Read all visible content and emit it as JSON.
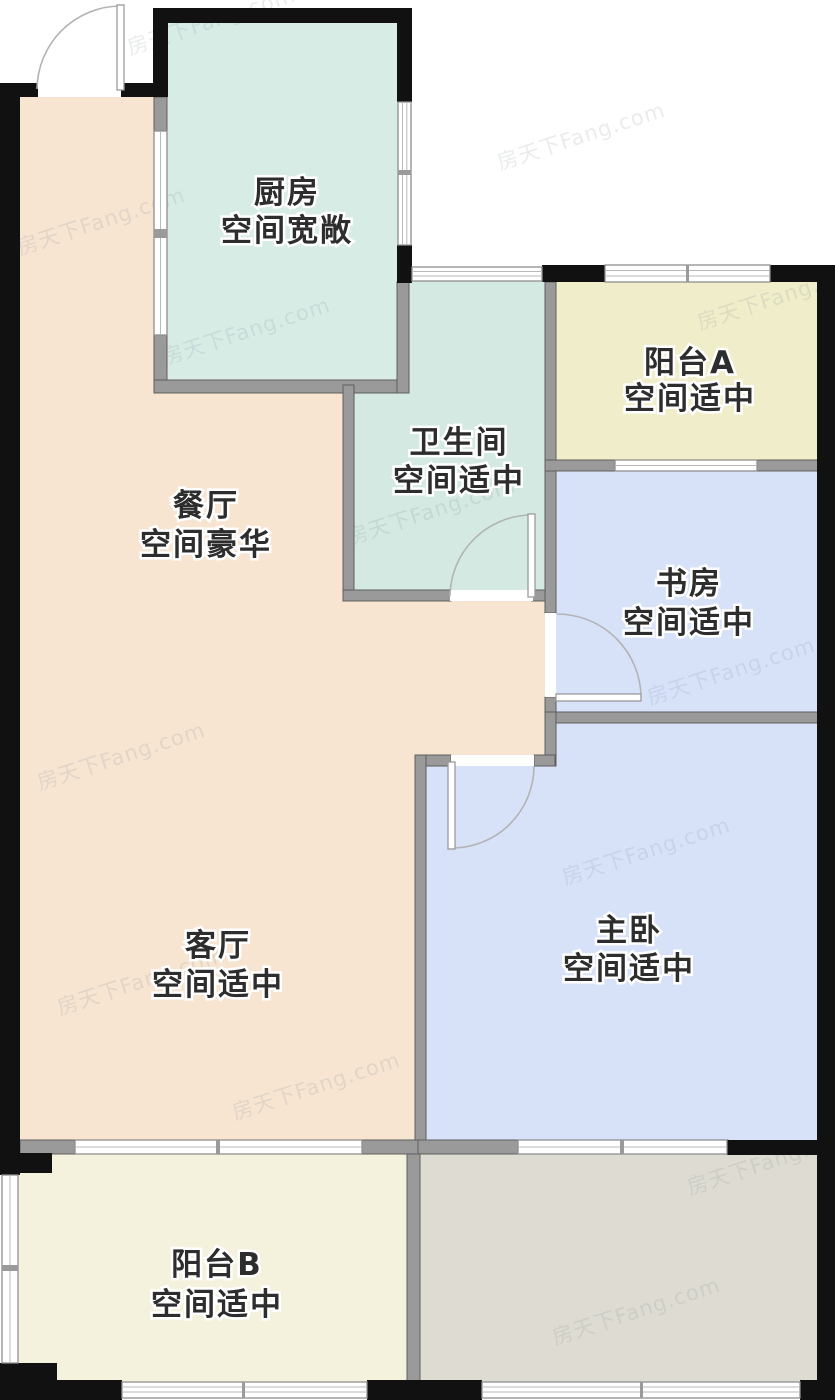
{
  "watermark_text": "房天下Fang.com",
  "walls": {
    "outer_color": "#111111",
    "inner_color": "#9a9a9a"
  },
  "rooms": {
    "kitchen": {
      "name": "厨房",
      "desc": "空间宽敞",
      "color": "#d8ece6"
    },
    "bathroom": {
      "name": "卫生间",
      "desc": "空间适中",
      "color": "#d3e9e2"
    },
    "dining": {
      "name": "餐厅",
      "desc": "空间豪华",
      "color": "#f7e5d2"
    },
    "living": {
      "name": "客厅",
      "desc": "空间适中",
      "color": "#f7e5d2"
    },
    "study": {
      "name": "书房",
      "desc": "空间适中",
      "color": "#d7e2f8"
    },
    "master_bedroom": {
      "name": "主卧",
      "desc": "空间适中",
      "color": "#d7e2f8"
    },
    "balcony_a": {
      "name": "阳台A",
      "desc": "空间适中",
      "color": "#f0edca"
    },
    "balcony_b": {
      "name": "阳台B",
      "desc": "空间适中",
      "color": "#f4f2dc"
    },
    "utility": {
      "color": "#dedcd2"
    }
  }
}
